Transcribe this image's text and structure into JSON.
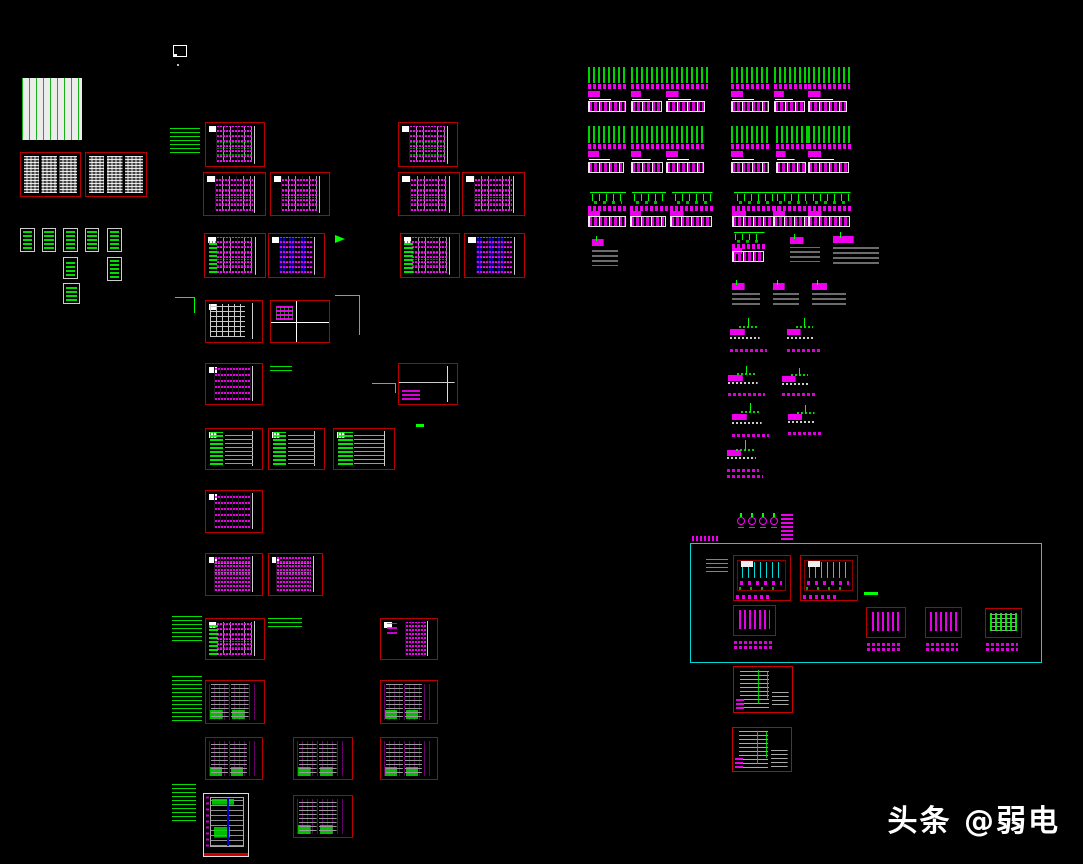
{
  "app": {
    "background": "#000000",
    "view": "cad-drawing-overview"
  },
  "palette": {
    "block_border_red": "#b80000",
    "annotation_green": "#00ff00",
    "text_magenta": "#ff00ff",
    "group_cyan": "#00d8d8",
    "table_gray": "#9a9a9a",
    "detail_blue": "#0000d7",
    "paper_white": "#ececec",
    "watermark_white": "#ffffff"
  },
  "watermark": {
    "text": "头条 @弱电",
    "color": "#ffffff"
  },
  "names": {
    "doclist": "drawing-list-table",
    "spec": "spec-text-block",
    "mini": "legend-item-block",
    "schedule": "panel-schedule-block",
    "schedule-g": "panel-schedule-block",
    "schedule-blue": "panel-schedule-block",
    "grid": "table-grid-block",
    "quad": "quadrant-layout-block",
    "ladder": "circuit-ladder-block",
    "ladder-m": "circuit-ladder-block",
    "magcol": "circuit-ladder-block",
    "two-ladder": "dual-ladder-schedule-block",
    "empty": "blank-frame-block",
    "riser": "riser-diagram-block",
    "tall": "system-diagram-block",
    "graystep": "schedule-table-block",
    "wiring": "wiring-detail-block",
    "nblock": "detail-symbol-block",
    "nblock-g": "detail-symbol-block",
    "group": "group-boundary-box"
  },
  "blocks": [
    [
      22,
      78,
      60,
      62,
      "doclist"
    ],
    [
      20,
      152,
      61,
      45,
      "spec"
    ],
    [
      85,
      152,
      62,
      45,
      "spec"
    ],
    [
      20,
      228,
      15,
      24,
      "mini"
    ],
    [
      42,
      228,
      14,
      24,
      "mini"
    ],
    [
      63,
      228,
      15,
      24,
      "mini"
    ],
    [
      85,
      228,
      14,
      24,
      "mini"
    ],
    [
      107,
      228,
      15,
      24,
      "mini"
    ],
    [
      63,
      257,
      15,
      22,
      "mini"
    ],
    [
      107,
      257,
      15,
      24,
      "mini"
    ],
    [
      63,
      283,
      17,
      21,
      "mini"
    ],
    [
      205,
      122,
      60,
      45,
      "schedule"
    ],
    [
      398,
      122,
      60,
      45,
      "schedule"
    ],
    [
      203,
      172,
      63,
      44,
      "schedule"
    ],
    [
      270,
      172,
      60,
      44,
      "schedule"
    ],
    [
      398,
      172,
      62,
      44,
      "schedule"
    ],
    [
      462,
      172,
      63,
      44,
      "schedule"
    ],
    [
      204,
      233,
      62,
      45,
      "schedule-g"
    ],
    [
      268,
      233,
      57,
      45,
      "schedule-blue"
    ],
    [
      400,
      233,
      60,
      45,
      "schedule-g"
    ],
    [
      464,
      233,
      61,
      45,
      "schedule-blue"
    ],
    [
      205,
      300,
      58,
      43,
      "grid"
    ],
    [
      270,
      300,
      60,
      43,
      "quad"
    ],
    [
      205,
      363,
      58,
      42,
      "ladder"
    ],
    [
      398,
      363,
      60,
      42,
      "empty"
    ],
    [
      205,
      428,
      58,
      42,
      "riser"
    ],
    [
      268,
      428,
      57,
      42,
      "riser"
    ],
    [
      333,
      428,
      62,
      42,
      "riser"
    ],
    [
      205,
      490,
      58,
      43,
      "ladder"
    ],
    [
      205,
      553,
      58,
      43,
      "ladder-m"
    ],
    [
      268,
      553,
      55,
      43,
      "ladder-m"
    ],
    [
      205,
      618,
      60,
      42,
      "schedule-g"
    ],
    [
      380,
      618,
      58,
      42,
      "magcol"
    ],
    [
      205,
      680,
      60,
      44,
      "two-ladder"
    ],
    [
      380,
      680,
      58,
      44,
      "two-ladder"
    ],
    [
      205,
      737,
      58,
      43,
      "two-ladder"
    ],
    [
      293,
      737,
      60,
      43,
      "two-ladder"
    ],
    [
      380,
      737,
      58,
      43,
      "two-ladder"
    ],
    [
      203,
      793,
      46,
      64,
      "tall"
    ],
    [
      293,
      795,
      60,
      43,
      "two-ladder"
    ],
    [
      690,
      543,
      352,
      120,
      "group"
    ],
    [
      733,
      555,
      58,
      46,
      "wiring"
    ],
    [
      800,
      555,
      58,
      46,
      "wiring"
    ],
    [
      733,
      605,
      43,
      31,
      "nblock"
    ],
    [
      866,
      607,
      40,
      31,
      "nblock"
    ],
    [
      925,
      607,
      37,
      31,
      "nblock"
    ],
    [
      985,
      608,
      37,
      30,
      "nblock-g"
    ],
    [
      733,
      666,
      60,
      47,
      "graystep"
    ],
    [
      732,
      727,
      60,
      45,
      "graystep"
    ]
  ],
  "clusters": [
    [
      588,
      67,
      40,
      45,
      1
    ],
    [
      631,
      67,
      33,
      45,
      1
    ],
    [
      666,
      67,
      42,
      45,
      1
    ],
    [
      731,
      67,
      40,
      45,
      1
    ],
    [
      774,
      67,
      33,
      45,
      1
    ],
    [
      808,
      67,
      42,
      45,
      1
    ],
    [
      588,
      126,
      38,
      47,
      1
    ],
    [
      631,
      126,
      34,
      47,
      1
    ],
    [
      666,
      126,
      40,
      47,
      1
    ],
    [
      731,
      126,
      40,
      47,
      1
    ],
    [
      776,
      126,
      32,
      47,
      1
    ],
    [
      808,
      126,
      44,
      47,
      1
    ],
    [
      588,
      192,
      40,
      35,
      2
    ],
    [
      630,
      192,
      38,
      35,
      2
    ],
    [
      670,
      192,
      45,
      35,
      2
    ],
    [
      732,
      192,
      48,
      35,
      2
    ],
    [
      773,
      192,
      40,
      35,
      2
    ],
    [
      808,
      192,
      45,
      35,
      2
    ],
    [
      592,
      236,
      26,
      30,
      3
    ],
    [
      732,
      232,
      34,
      30,
      2
    ],
    [
      790,
      234,
      30,
      28,
      3
    ],
    [
      833,
      232,
      46,
      32,
      3
    ],
    [
      732,
      280,
      28,
      25,
      3
    ],
    [
      773,
      280,
      26,
      25,
      3
    ],
    [
      812,
      280,
      34,
      25,
      3
    ],
    [
      730,
      318,
      37,
      34,
      4
    ],
    [
      787,
      318,
      34,
      34,
      4
    ],
    [
      728,
      366,
      37,
      30,
      4
    ],
    [
      782,
      368,
      34,
      28,
      4
    ],
    [
      732,
      403,
      37,
      34,
      4
    ],
    [
      788,
      405,
      35,
      30,
      4
    ],
    [
      727,
      440,
      36,
      38,
      5
    ]
  ],
  "marks": [
    [
      170,
      125,
      30,
      28,
      "note"
    ],
    [
      172,
      615,
      30,
      26,
      "note"
    ],
    [
      268,
      617,
      34,
      10,
      "note"
    ],
    [
      172,
      675,
      30,
      46,
      "note"
    ],
    [
      172,
      783,
      24,
      38,
      "note"
    ],
    [
      270,
      363,
      22,
      8,
      "note"
    ],
    [
      706,
      556,
      22,
      16,
      "note"
    ],
    [
      175,
      297,
      20,
      16,
      "bracket"
    ],
    [
      335,
      295,
      25,
      40,
      "bracket"
    ],
    [
      372,
      383,
      24,
      10,
      "bracket"
    ],
    [
      335,
      235,
      24,
      13,
      "arrow"
    ],
    [
      416,
      424,
      8,
      3,
      "dash"
    ],
    [
      864,
      592,
      14,
      3,
      "dash"
    ],
    [
      692,
      536,
      26,
      5,
      "glabel"
    ],
    [
      737,
      517,
      8,
      8,
      "lamp"
    ],
    [
      748,
      517,
      8,
      8,
      "lamp"
    ],
    [
      759,
      517,
      8,
      8,
      "lamp"
    ],
    [
      770,
      517,
      8,
      8,
      "lamp"
    ],
    [
      781,
      513,
      12,
      27,
      "glyphcol"
    ]
  ],
  "mark_names": {
    "note": "annotation-note-text",
    "bracket": "leader-bracket",
    "arrow": "leader-arrow",
    "dash": "annotation-dash",
    "glabel": "group-box-label",
    "lamp": "luminaire-symbol",
    "glyphcol": "symbol-stack"
  }
}
